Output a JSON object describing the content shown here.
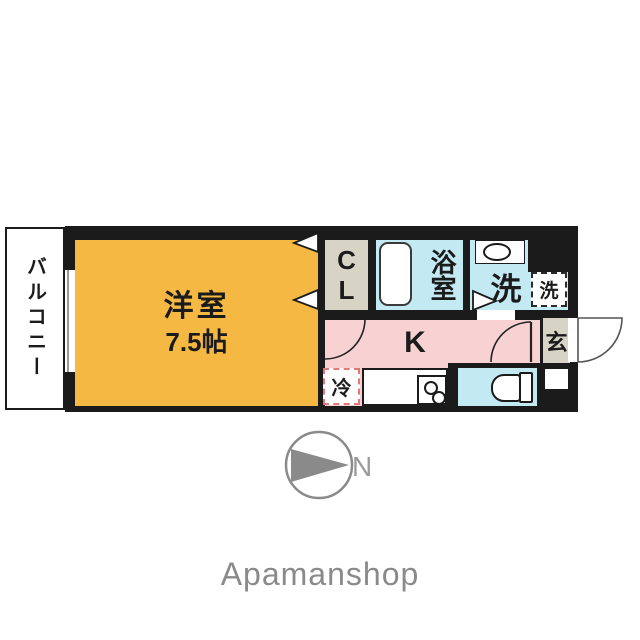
{
  "colors": {
    "room_orange": "#f5b842",
    "room_pink": "#f8d2d2",
    "room_blue": "#c3e9f3",
    "room_beige": "#d7d3c5",
    "wall_black": "#1b1b1b",
    "compass_gray": "#8a8a8a",
    "fridge_dash_red": "#e07a7a"
  },
  "floorplan": {
    "balcony": {
      "label": "バルコニー"
    },
    "living_room": {
      "name": "洋室",
      "size": "7.5帖"
    },
    "closet": {
      "label": "CL"
    },
    "bathroom": {
      "label": "浴室"
    },
    "washroom": {
      "label": "洗"
    },
    "washer_space": {
      "label": "洗"
    },
    "kitchen": {
      "label": "K"
    },
    "fridge_space": {
      "label": "冷"
    },
    "entrance": {
      "label": "玄"
    },
    "compass": {
      "label": "N"
    }
  },
  "footer": {
    "brand": "Apamanshop"
  }
}
